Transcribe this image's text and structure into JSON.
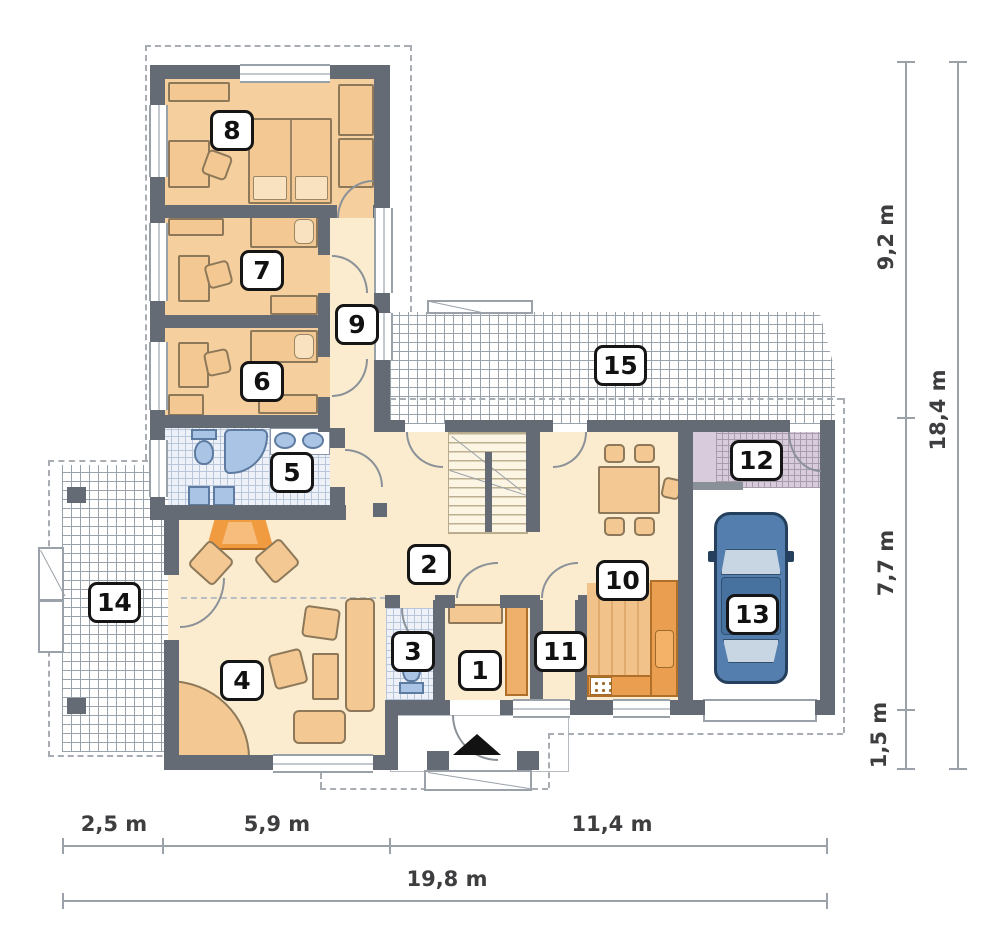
{
  "plan": {
    "type": "house-floor-plan",
    "rooms": {
      "r1": "1",
      "r2": "2",
      "r3": "3",
      "r4": "4",
      "r5": "5",
      "r6": "6",
      "r7": "7",
      "r8": "8",
      "r9": "9",
      "r10": "10",
      "r11": "11",
      "r12": "12",
      "r13": "13",
      "r14": "14",
      "r15": "15"
    },
    "dims": {
      "right": {
        "segments": [
          "9,2 m",
          "7,7 m",
          "1,5 m"
        ],
        "total": "18,4 m"
      },
      "bottom": {
        "segments": [
          "2,5 m",
          "5,9 m",
          "11,4 m"
        ],
        "total": "19,8 m"
      }
    },
    "icons": {
      "entrance_arrow": "triangle-up",
      "car": "car-top-view",
      "fireplace": "corner-fireplace",
      "stairs": "u-shaped-staircase"
    },
    "colors": {
      "wall": "#656b74",
      "bedroom_floor": "#f6cf9e",
      "hall_floor": "#fbeccf",
      "kitchen_counter": "#ea9e4f",
      "kitchen_floor": "#f2c28b",
      "bath_fixture_blue": "#a9c4e4",
      "utility_lavender": "#d8cbdb",
      "car_blue": "#537ead",
      "furniture_tan": "#f3c892",
      "fireplace_orange": "#f09b40",
      "dimension_gray": "#9aa1a9",
      "label_text": "#111111"
    }
  }
}
